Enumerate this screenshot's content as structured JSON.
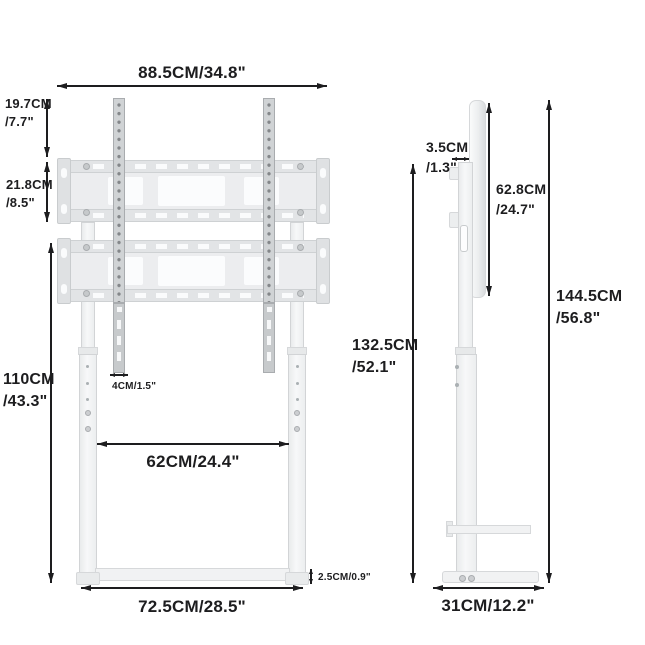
{
  "front_view": {
    "dimensions": {
      "top_width": "88.5CM/34.8\"",
      "rail_overhang": {
        "cm": "19.7CM",
        "in": "/7.7\""
      },
      "bracket_height": {
        "cm": "21.8CM",
        "in": "/8.5\""
      },
      "stand_height": {
        "cm": "110CM",
        "in": "/43.3\""
      },
      "rail_width": "4CM/1.5\"",
      "inner_width": "62CM/24.4\"",
      "base_width": "72.5CM/28.5\"",
      "base_thickness": "2.5CM/0.9\""
    }
  },
  "side_view": {
    "dimensions": {
      "bracket_depth": {
        "cm": "3.5CM",
        "in": "/1.3\""
      },
      "bracket_plate_height": {
        "cm": "62.8CM",
        "in": "/24.7\""
      },
      "adjustable_column_height": {
        "cm": "132.5CM",
        "in": "/52.1\""
      },
      "total_height": {
        "cm": "144.5CM",
        "in": "/56.8\""
      },
      "base_depth": "31CM/12.2\""
    }
  },
  "colors": {
    "dimension_line": "#1d1d1f",
    "text": "#1d1d1f",
    "product_light": "#f1f2f3",
    "product_border": "#d6d8da",
    "rail_gray": "#d0d3d5",
    "background": "#ffffff"
  }
}
